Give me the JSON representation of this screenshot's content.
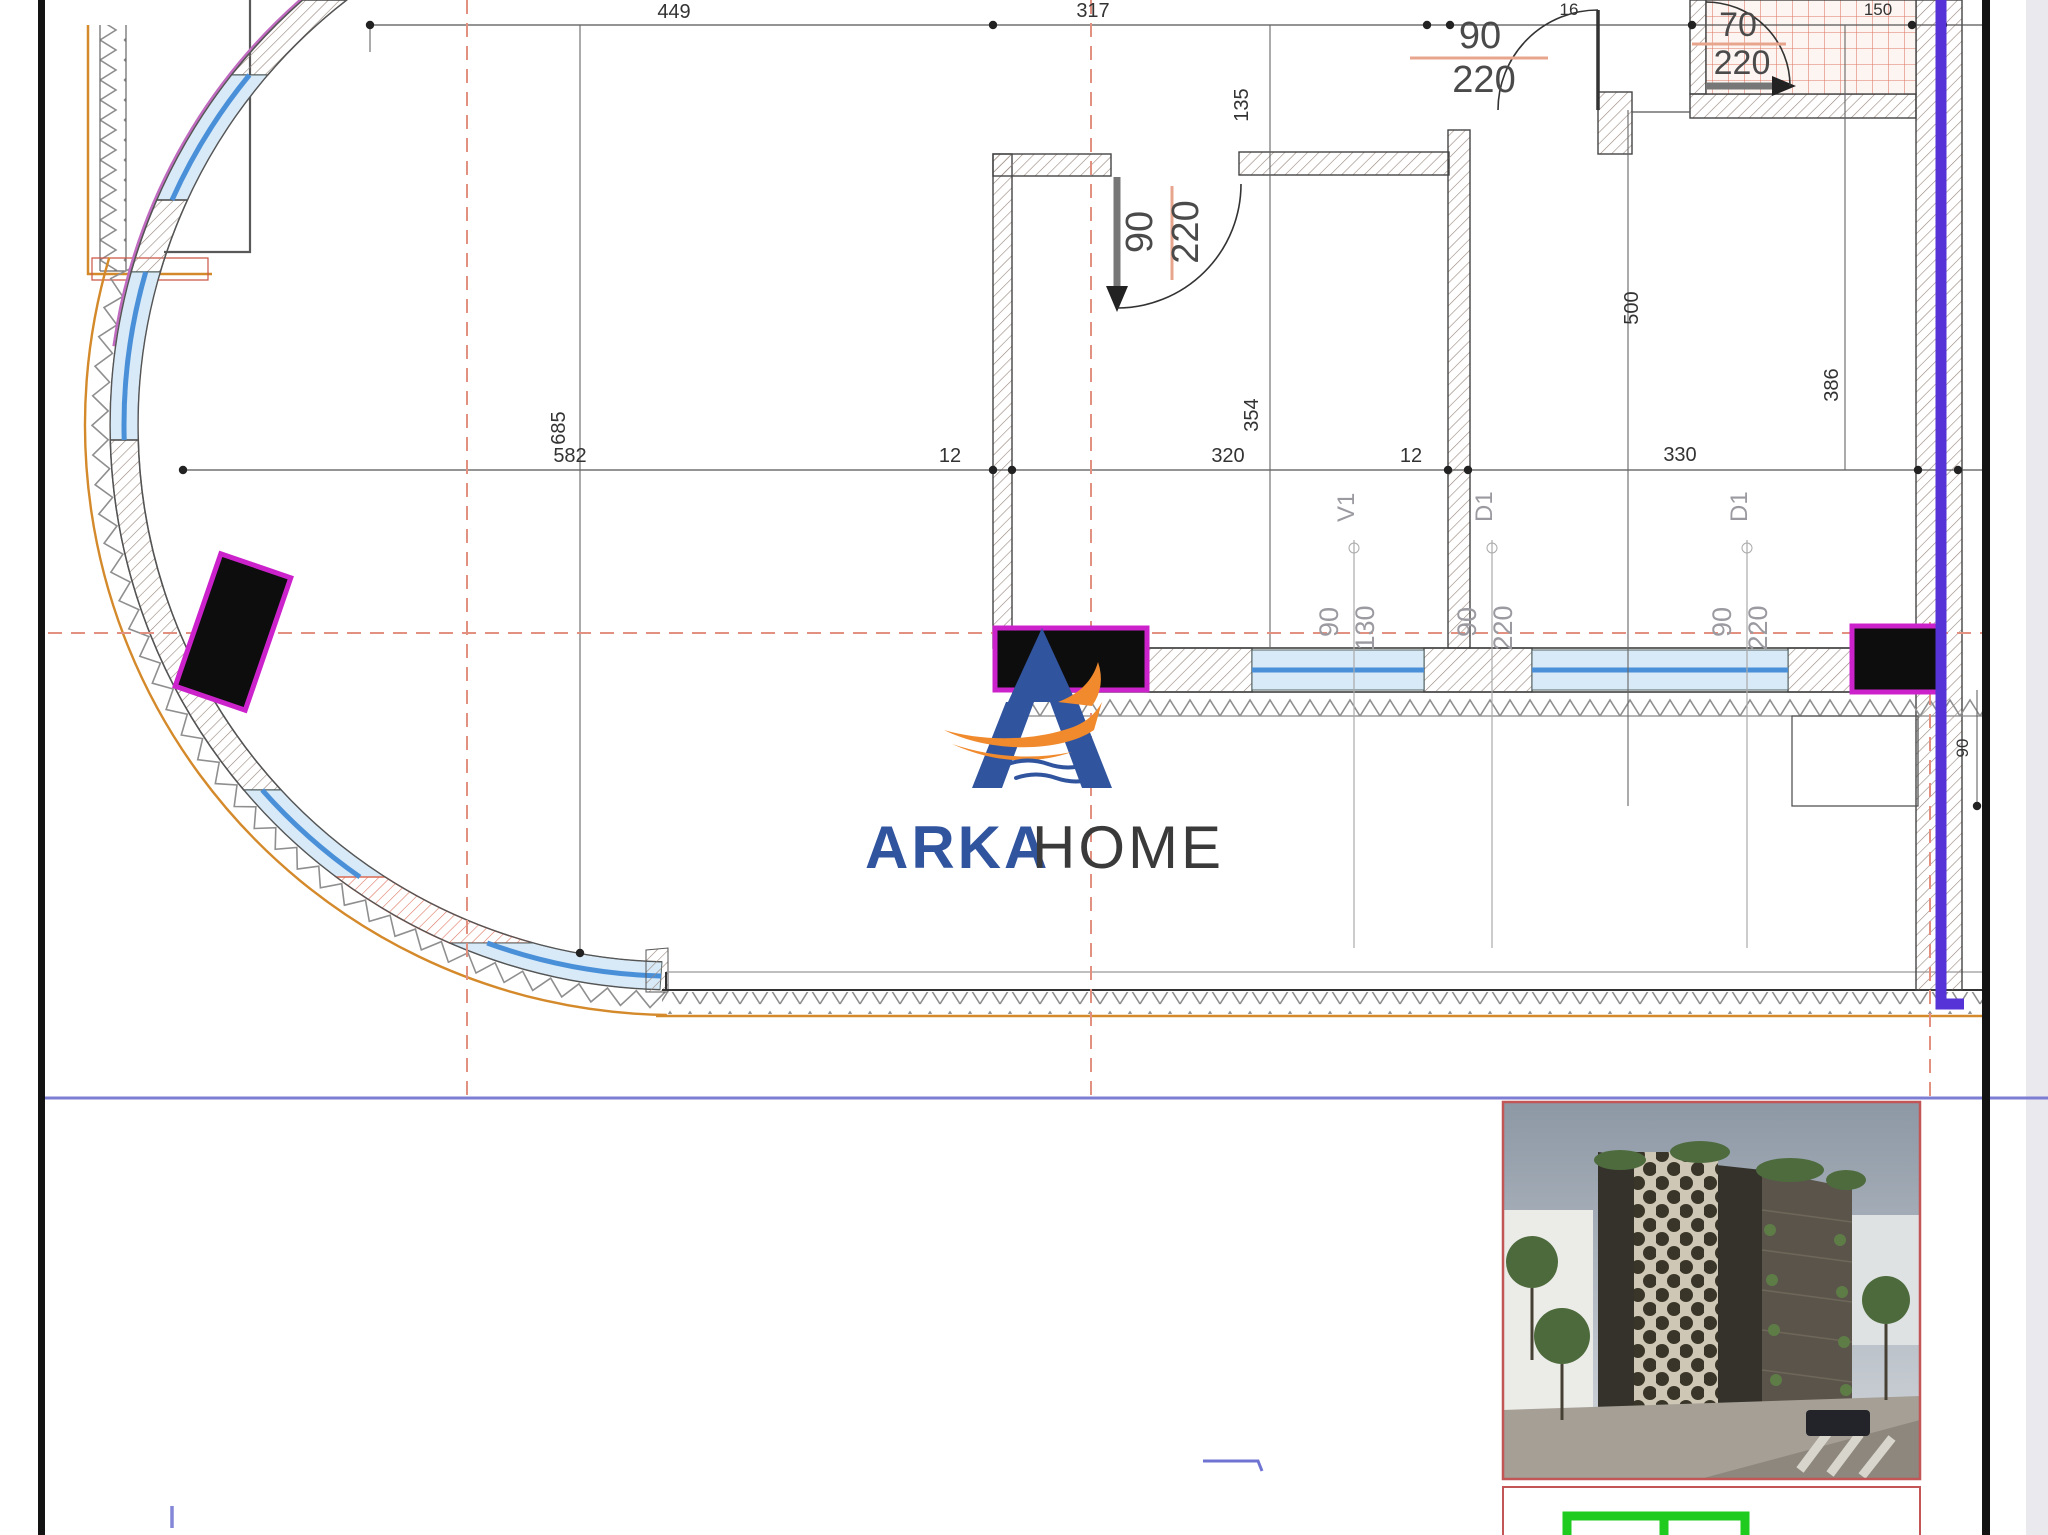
{
  "dim_labels": {
    "top": {
      "a": "449",
      "b": "317",
      "c": "16",
      "d": "150"
    },
    "verticals": {
      "v135": "135",
      "v500": "500",
      "v386": "386",
      "v354": "354",
      "v685": "685",
      "v90": "90"
    },
    "mid": {
      "m582": "582",
      "m12a": "12",
      "m320": "320",
      "m12b": "12",
      "m330": "330"
    }
  },
  "door_labels": {
    "d1": {
      "w": "90",
      "h": "220"
    },
    "d2": {
      "w": "90",
      "h": "220"
    },
    "d3": {
      "w": "70",
      "h": "220"
    }
  },
  "opening_tags": {
    "v1": {
      "tag": "V1",
      "w": "90",
      "h": "130"
    },
    "d1a": {
      "tag": "D1",
      "w": "90",
      "h": "220"
    },
    "d1b": {
      "tag": "D1",
      "w": "90",
      "h": "220"
    }
  },
  "logo": {
    "arka": "ARKA",
    "home": "HOME"
  },
  "colors": {
    "wall-hatch": "#97867c",
    "red-hatch": "#dd7763",
    "window-blue": "#4a90d9",
    "axis-red": "#e2907f",
    "outer-orange": "#d4892a",
    "magenta-line": "#c06ac0",
    "column-outline": "#cc22cc",
    "purple-riser": "#5633d6",
    "page-blue": "#7d7dd4",
    "logo-blue": "#31549f",
    "logo-orange": "#f08a2d",
    "frame-red": "#c25555",
    "green-box": "#1ecb1e"
  }
}
